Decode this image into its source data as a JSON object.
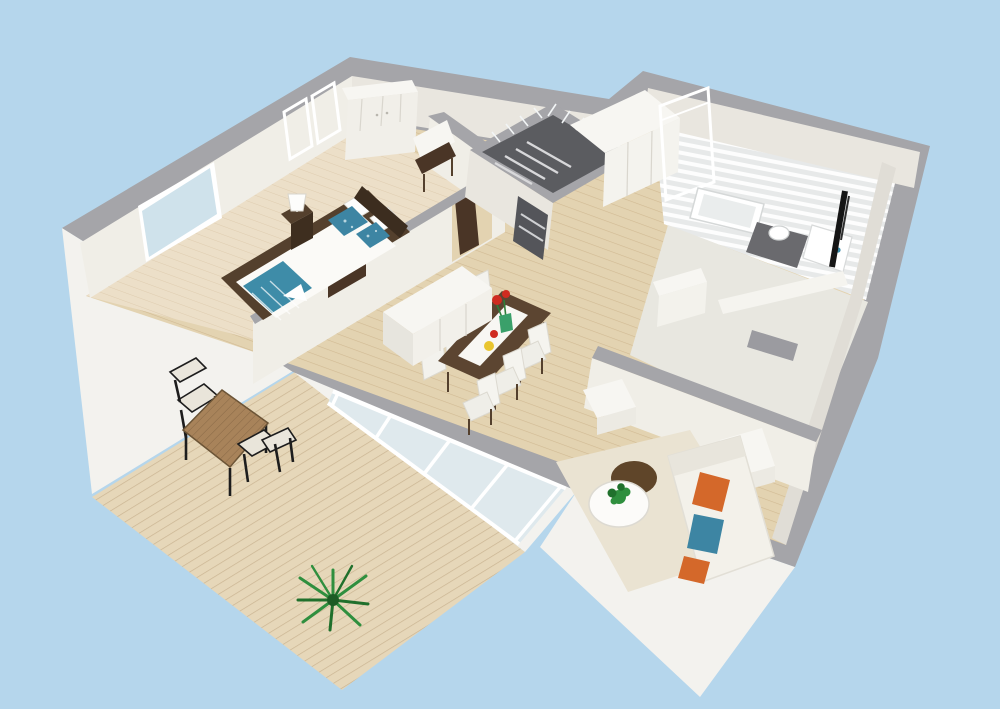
{
  "scene": {
    "description": "Aerial 3D dollhouse floor plan render of an apartment on a light blue background",
    "style": "roomsketcher-like 3d snapshot",
    "rooms": [
      {
        "name": "bedroom",
        "position": "top-left",
        "furniture": [
          "double-bed",
          "nightstand",
          "table-lamp",
          "wardrobe",
          "window"
        ]
      },
      {
        "name": "hallway",
        "position": "center",
        "furniture": [
          "storage-cabinets",
          "wall-desk",
          "entry-door-open"
        ]
      },
      {
        "name": "staircase-core",
        "position": "center-top",
        "furniture": [
          "stairs",
          "glass-balustrade"
        ]
      },
      {
        "name": "bathroom",
        "position": "top-right",
        "furniture": [
          "bathtub",
          "toilet",
          "vanity-sink",
          "black-radiator",
          "dark-floor-tiles",
          "slatted-skylight"
        ]
      },
      {
        "name": "second-room",
        "position": "middle-right",
        "furniture": [
          "white-dresser",
          "low-bench",
          "radiator"
        ]
      },
      {
        "name": "dining-area",
        "position": "center",
        "furniture": [
          "dining-table",
          "six-white-chairs",
          "sideboard",
          "red-flowers",
          "yellow-plate"
        ]
      },
      {
        "name": "living-room",
        "position": "bottom-right",
        "furniture": [
          "white-sofa",
          "orange-pillows",
          "blue-pillow",
          "round-coffee-table",
          "potted-plant",
          "brown-ottoman",
          "side-tables",
          "area-rug"
        ]
      },
      {
        "name": "terrace",
        "position": "bottom-left",
        "furniture": [
          "wood-deck",
          "bistro-table",
          "two-chairs",
          "green-plant"
        ]
      }
    ]
  },
  "colors": {
    "bg": "#b5d6ec",
    "wall_top": "#a5a5a9",
    "facade": "#f3f2ee",
    "face_light": "#f0eee7",
    "face": "#e9e6df",
    "face_dim": "#e0ddd6",
    "floor_oak": "#e3d3b1",
    "floor_bedroom": "#ecdfc8",
    "oak_line": "#b99a6e",
    "deck": "#e6d7b9",
    "deck_line": "#b89d78",
    "bath_floor": "#e7e9e9",
    "bath_dark": "#6a6a6e",
    "room2_floor": "#e8e7e0",
    "rug": "#eae3d2",
    "glass": "#cfe2eb",
    "glass_pale": "#dfe9ed",
    "entry_glass": "#b6e0f5",
    "wood_dark": "#54402d",
    "table_wood": "#5c4531",
    "terrace_table": "#a8835a",
    "furn_white": "#f7f6f2",
    "sofa": "#f3f1ea",
    "teal": "#3e8ca8",
    "pillow_blue": "#3d85a3",
    "orange": "#d4682a",
    "red": "#cf2b20",
    "yellow": "#e9c52f",
    "green": "#2f8f3e",
    "green_dark": "#20702c",
    "ottoman": "#5f4529",
    "door_brown": "#4a3526",
    "stair_dark": "#5b5c60",
    "gray_mid": "#9b9ba0"
  }
}
